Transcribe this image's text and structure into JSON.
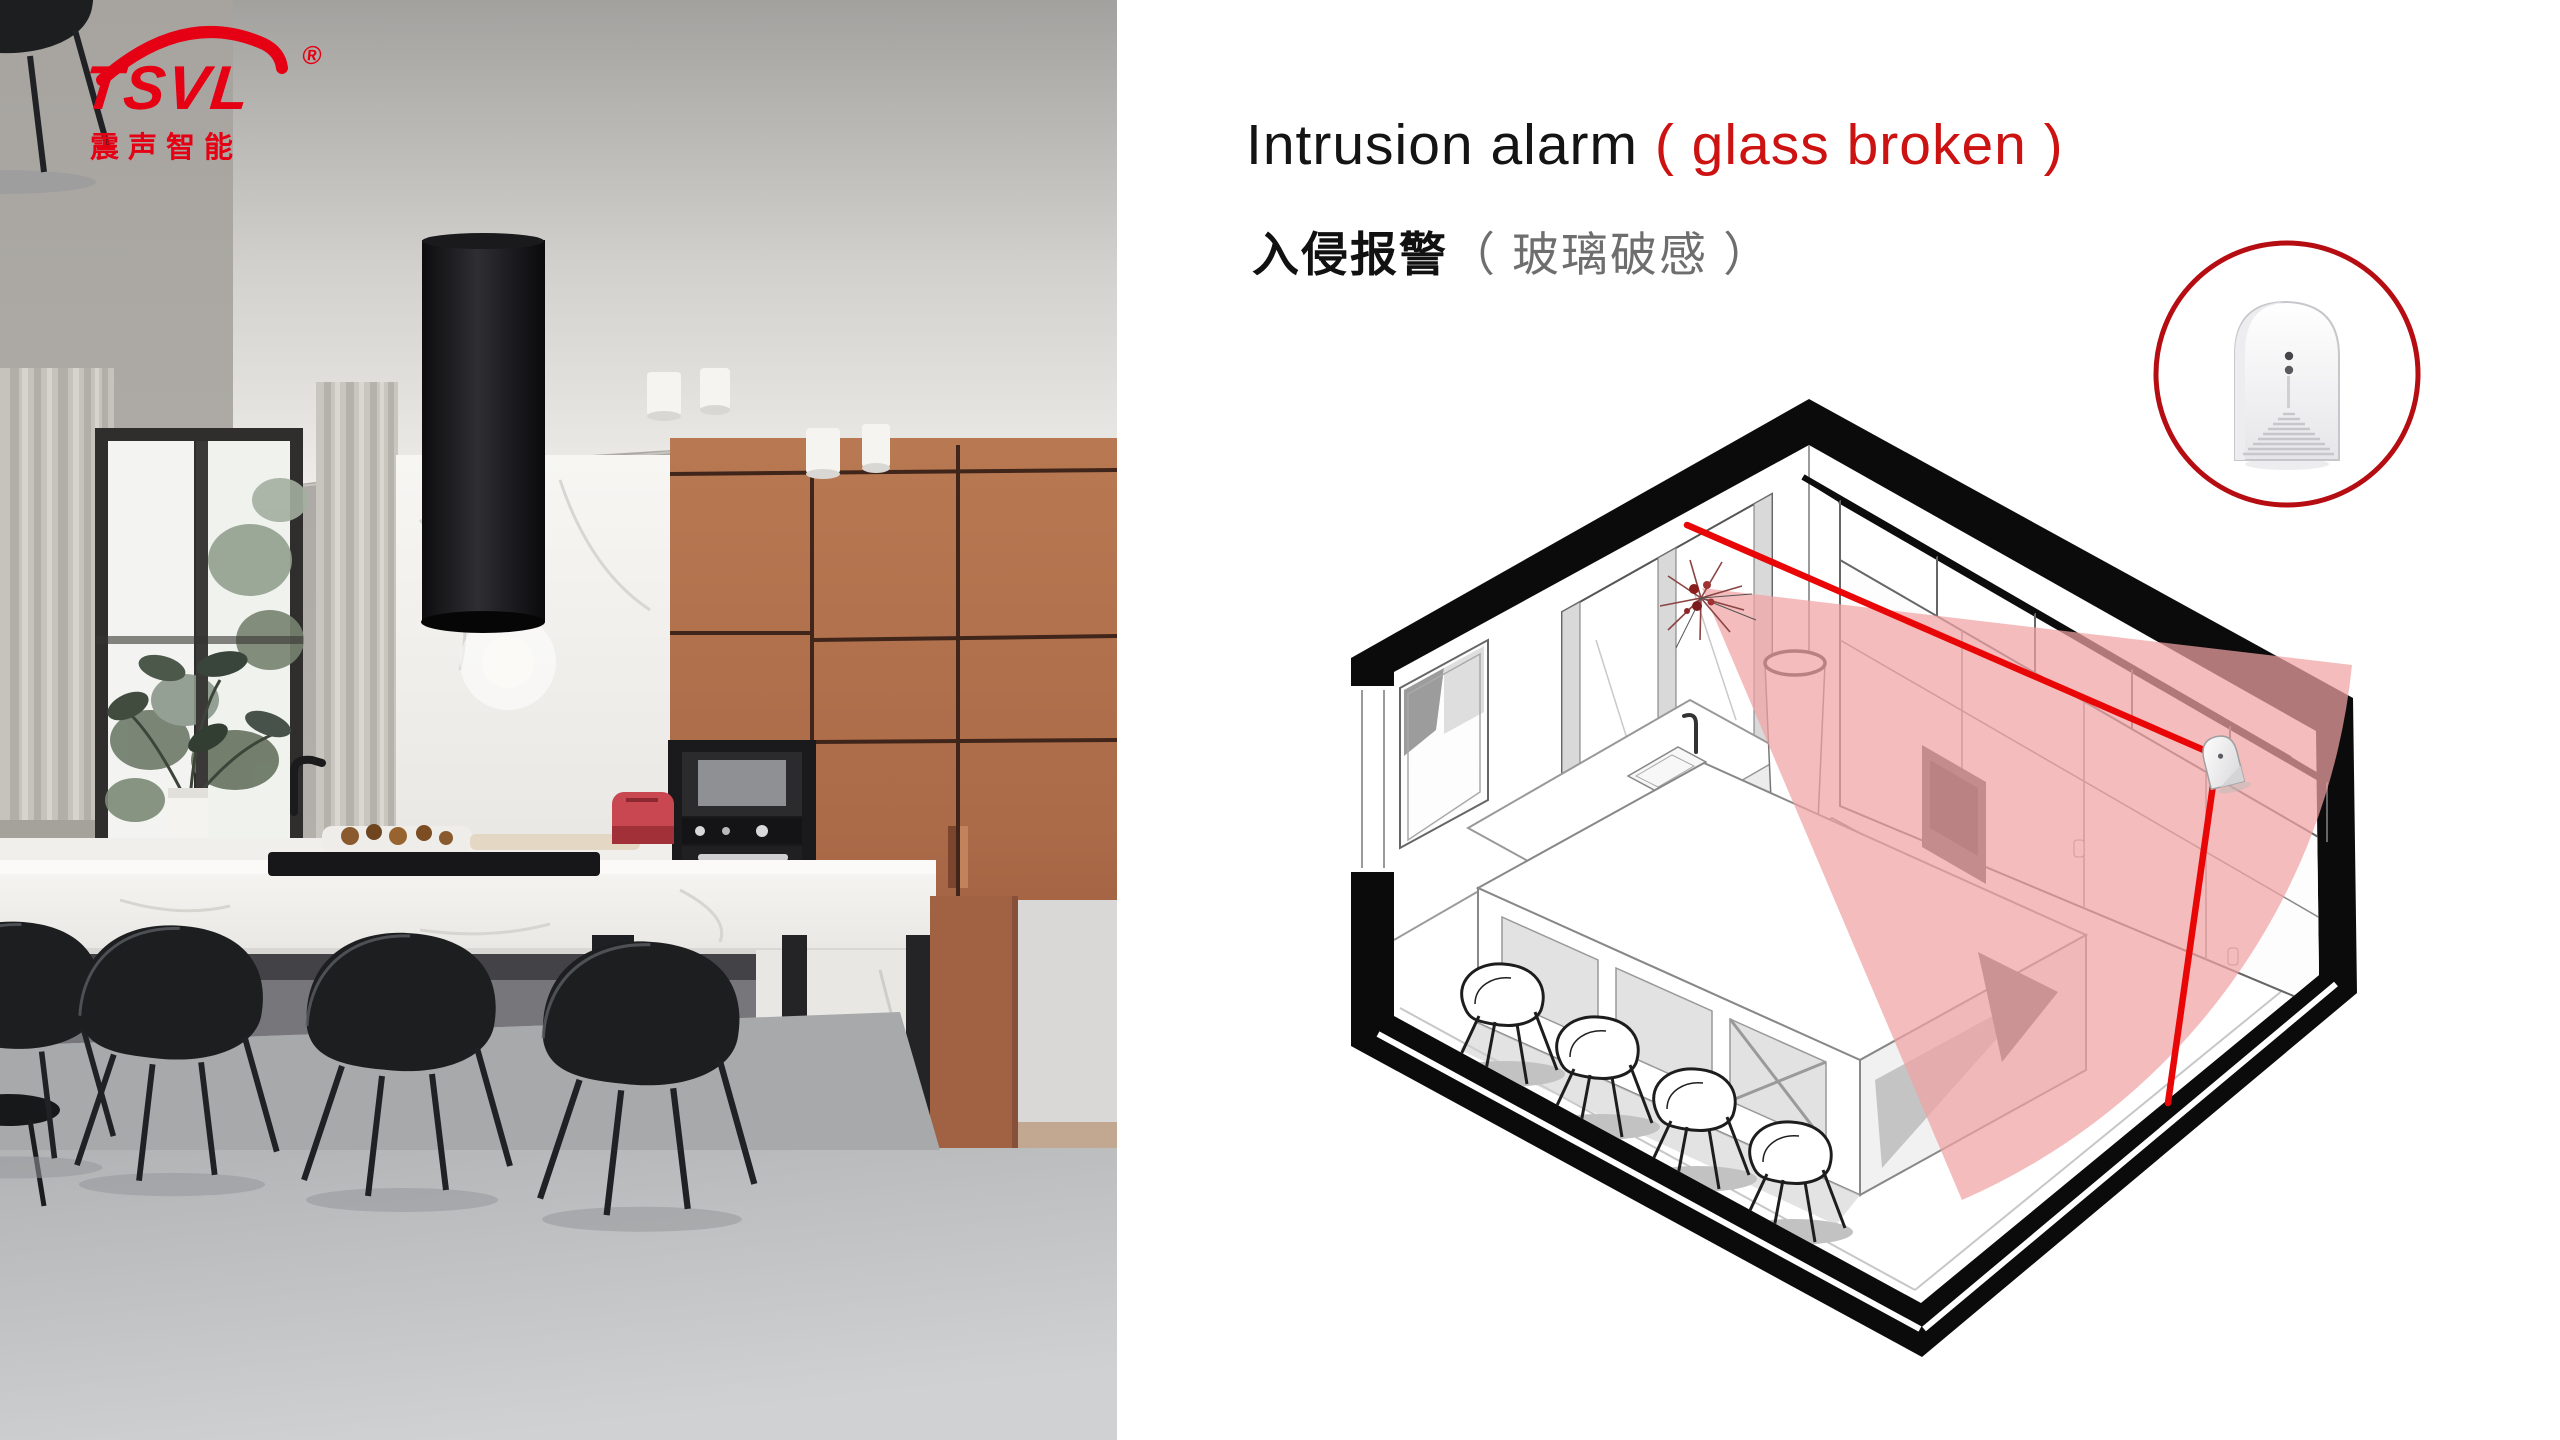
{
  "logo": {
    "brand": "TSVL",
    "registered": "®",
    "subtitle": "震声智能"
  },
  "heading": {
    "en_black": "Intrusion alarm",
    "en_red": "( glass broken )",
    "zh_black": "入侵报警",
    "zh_paren": "（ 玻璃破感 ）"
  },
  "colors": {
    "logo_red": "#e60014",
    "accent_red": "#cd1212",
    "circle_red": "#b50d12",
    "line_red": "#e90606",
    "cone_pink": "#f0a2a2",
    "copper": "#ad6c4a",
    "photo_wall_gray": "#a9a6a2",
    "floor_gray": "#c2c3c5"
  },
  "icons": {
    "product_badge": "glass-break-sensor-in-red-circle",
    "starburst": "glass-break-impact",
    "cone": "detection-coverage-fan",
    "sensor": "wall-mounted-glass-break-sensor"
  },
  "diagram": {
    "type": "isometric-room-cutaway",
    "scene": "kitchen with island, chairs, window wall and wardrobe wall",
    "device": "glass break sensor on right-hand cabinet wall",
    "annotations": "red sight line from broken window glass to sensor; red line from sensor to floor; pink detection fan from impact point"
  }
}
